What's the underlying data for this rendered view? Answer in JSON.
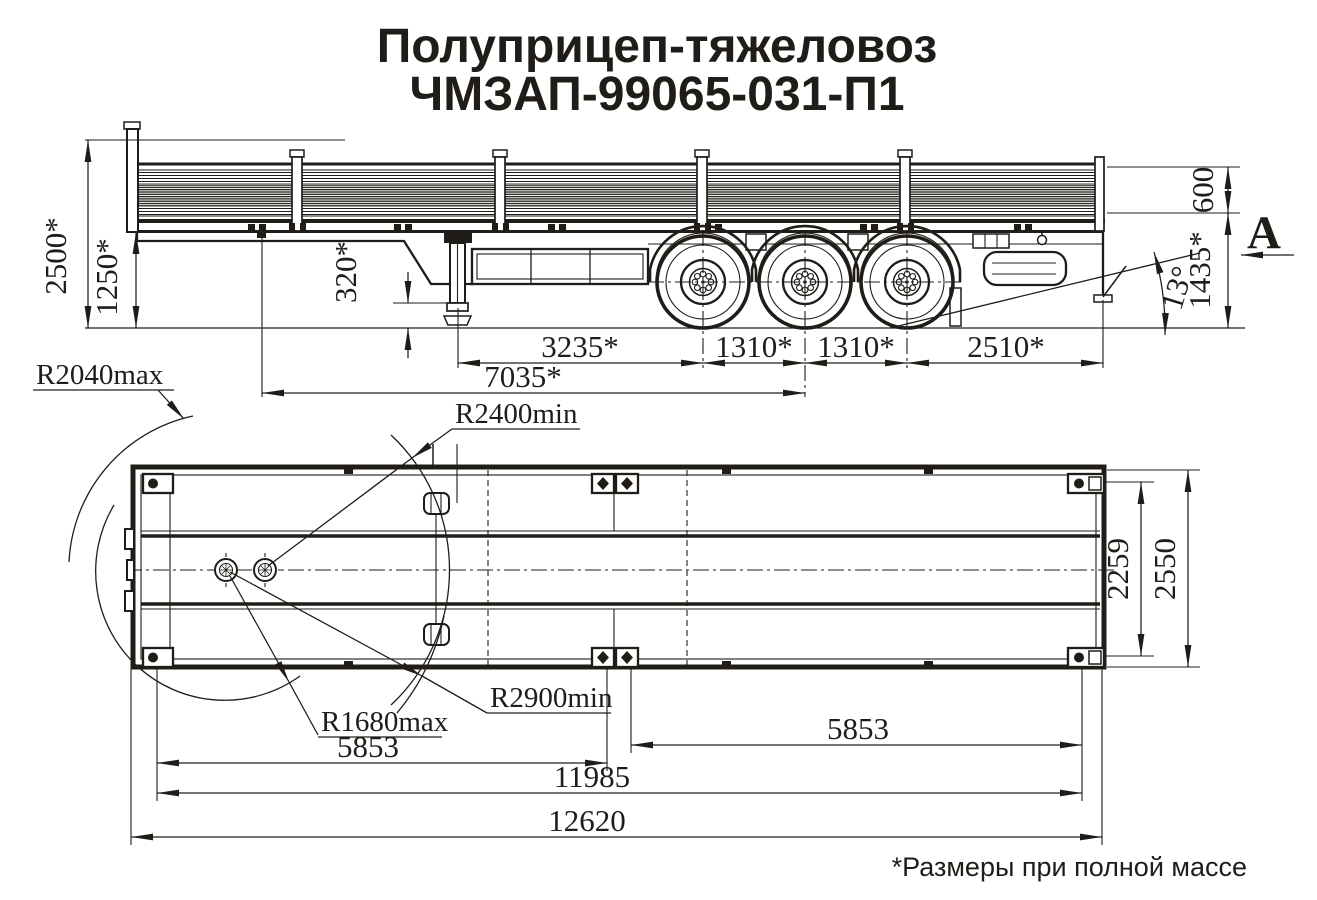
{
  "colors": {
    "ink": "#201d18",
    "paper": "#ffffff"
  },
  "title": {
    "line1": "Полуприцеп-тяжеловоз",
    "line2": "ЧМЗАП-99065-031-П1"
  },
  "footnote": "*Размеры при полной массе",
  "side_view": {
    "view_label": "A",
    "dims": {
      "overall_height": "2500*",
      "front_frame_height": "1250*",
      "support_clearance": "320*",
      "support_to_axle1": "3235*",
      "axle1_to_axle2": "1310*",
      "axle2_to_axle3": "1310*",
      "axle3_to_rear": "2510*",
      "kingpin_to_bogie": "7035*",
      "board_height": "600",
      "platform_height": "1435*",
      "departure_angle": "13°"
    }
  },
  "top_view": {
    "dims": {
      "r_front_swing_max": "R2040max",
      "r_front_clearance_min": "R2400min",
      "r_rear_clearance_min": "R2900min",
      "r_rear_swing_max": "R1680max",
      "section_front": "5853",
      "section_rear": "5853",
      "frame_length": "11985",
      "overall_length": "12620",
      "inner_width": "2259",
      "overall_width": "2550"
    }
  }
}
